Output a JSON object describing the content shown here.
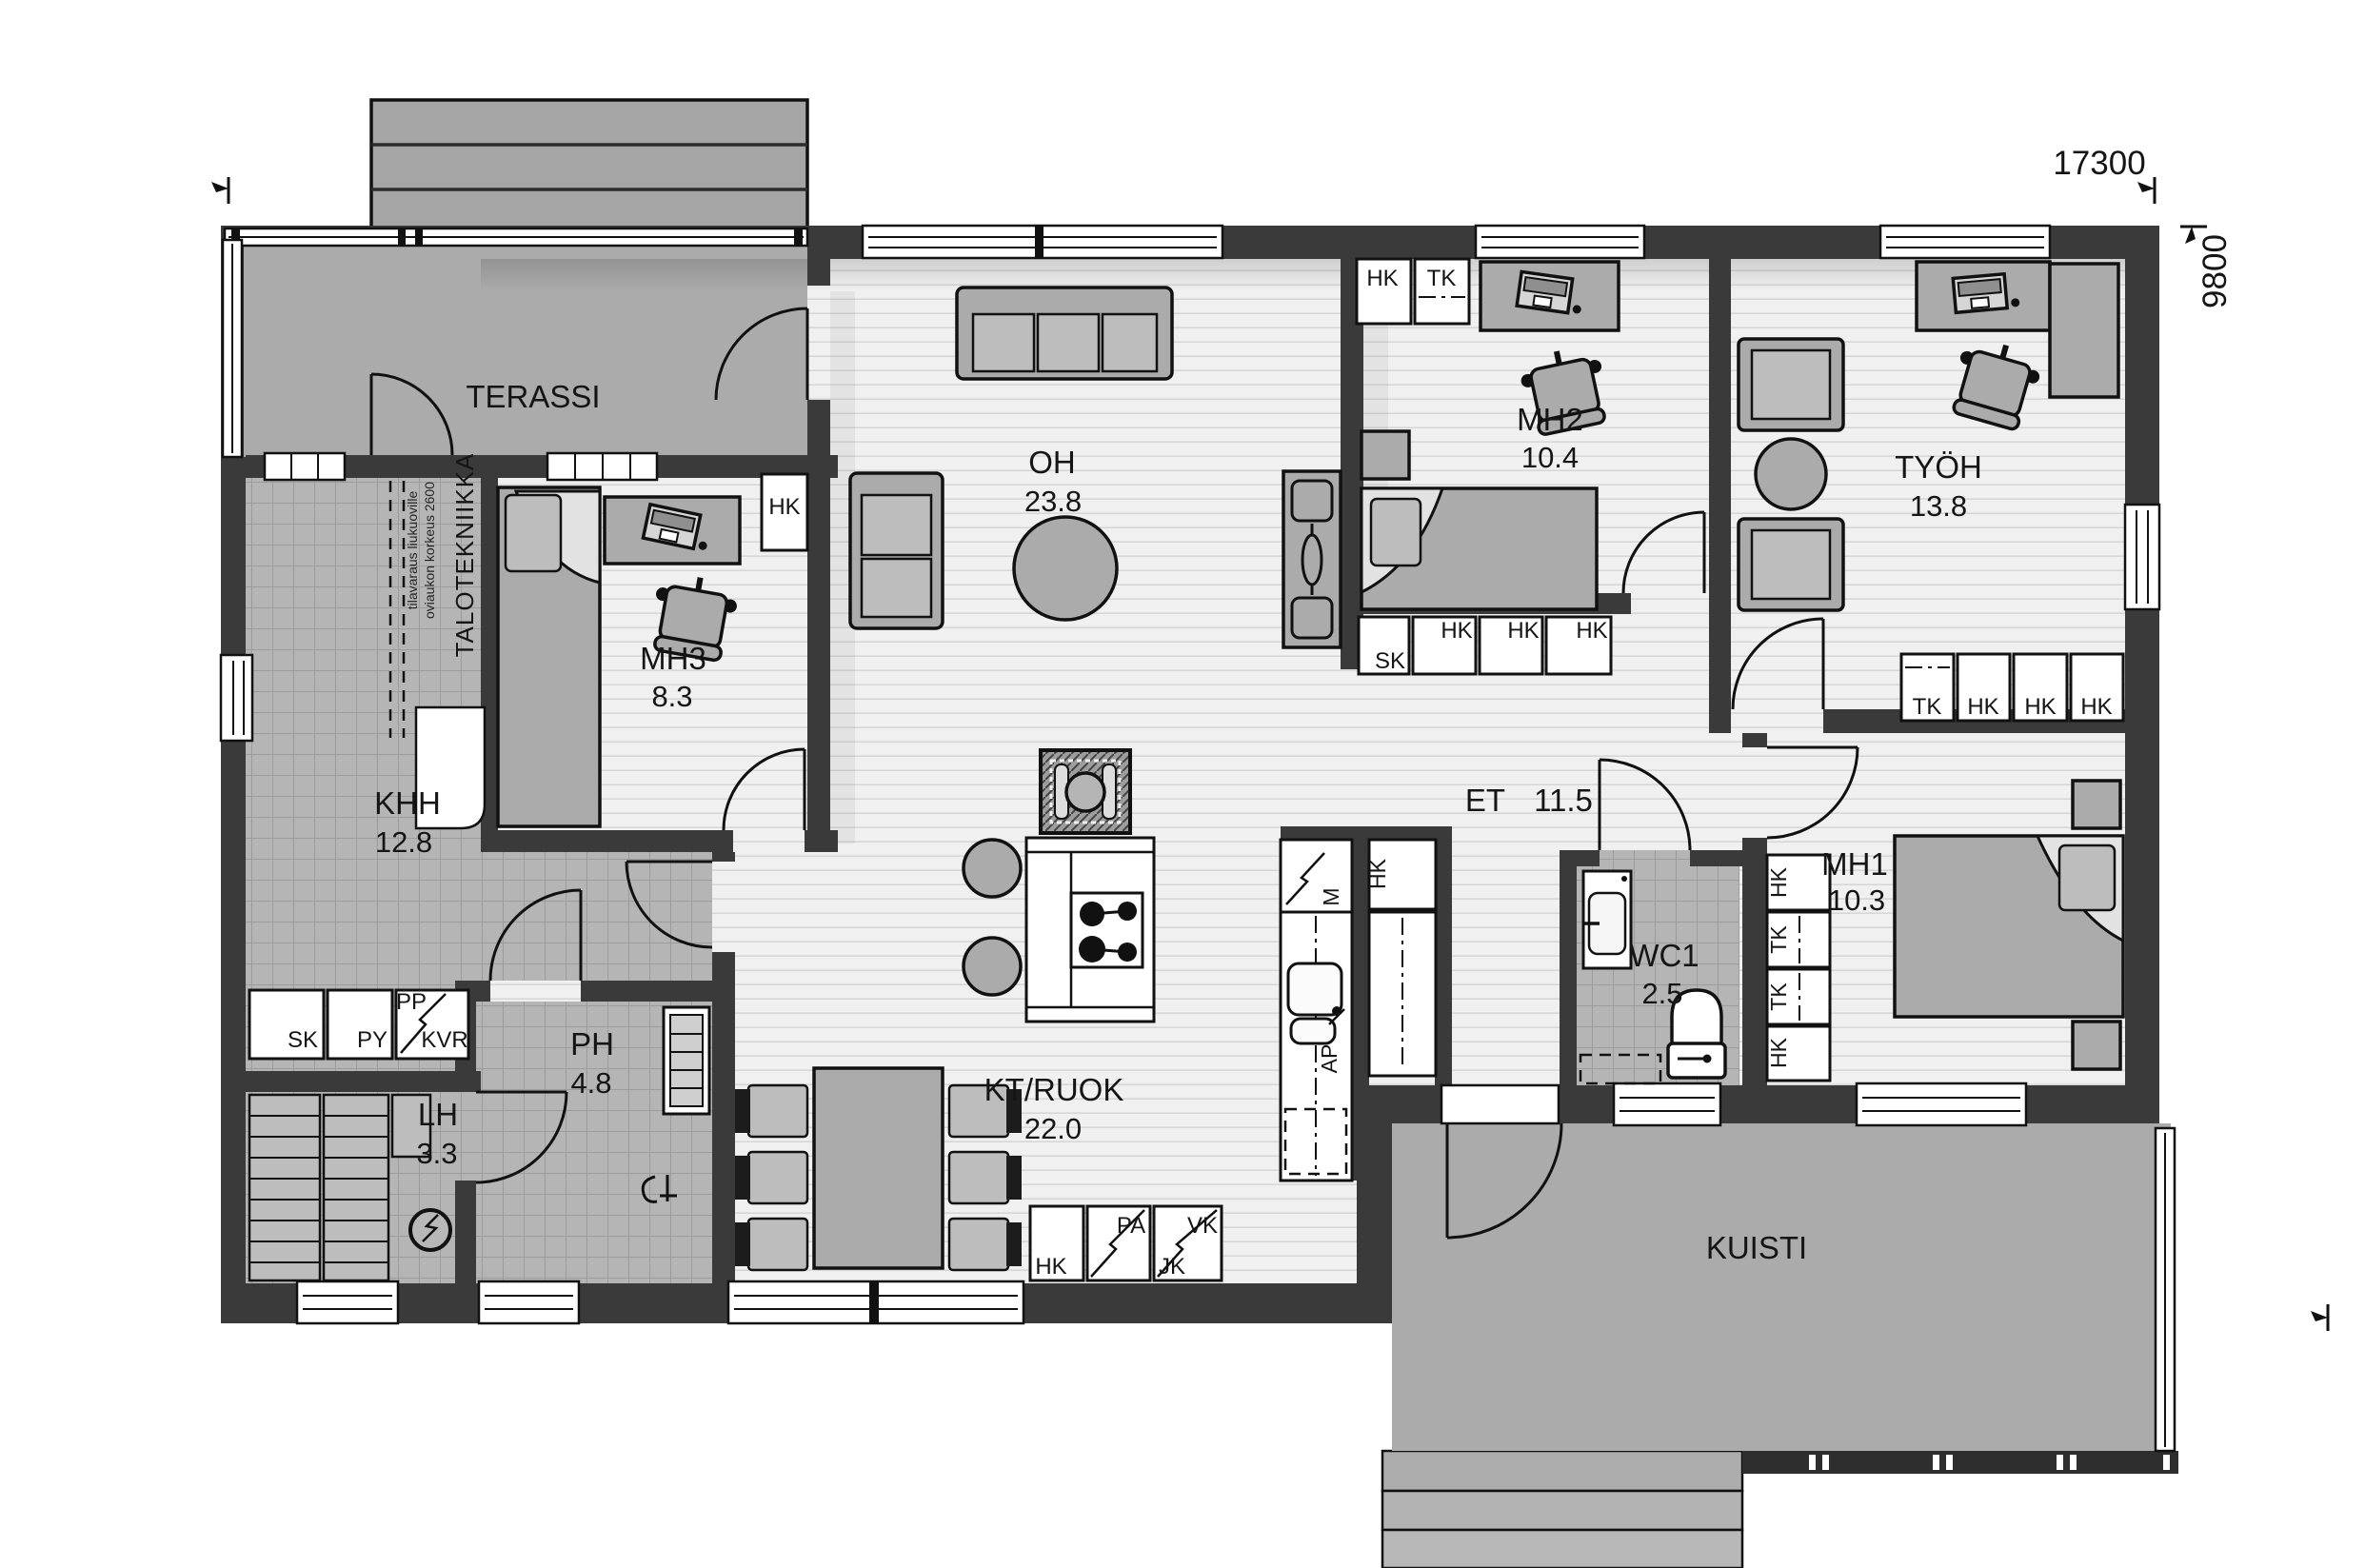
{
  "plan": {
    "dims": {
      "width_label": "17300",
      "height_label": "9800"
    },
    "rooms": {
      "terassi": {
        "name": "TERASSI"
      },
      "oh": {
        "name": "OH",
        "area": "23.8"
      },
      "mh2": {
        "name": "MH2",
        "area": "10.4"
      },
      "tyoh": {
        "name": "TYÖH",
        "area": "13.8"
      },
      "mh3": {
        "name": "MH3",
        "area": "8.3"
      },
      "khh": {
        "name": "KHH",
        "area": "12.8"
      },
      "et": {
        "name": "ET",
        "area": "11.5"
      },
      "mh1": {
        "name": "MH1",
        "area": "10.3"
      },
      "wc1": {
        "name": "WC1",
        "area": "2.5"
      },
      "ph": {
        "name": "PH",
        "area": "4.8"
      },
      "lh": {
        "name": "LH",
        "area": "3.3"
      },
      "ktruok": {
        "name": "KT/RUOK",
        "area": "22.0"
      },
      "kuisti": {
        "name": "KUISTI"
      }
    },
    "zones": {
      "talotekniikka": "TALOTEKNIIKKA"
    },
    "notes": {
      "line1": "tilavaraus liukuoville",
      "line2": "oviaukon korkeus 2600"
    },
    "cabinets": {
      "hk": "HK",
      "tk": "TK",
      "sk": "SK",
      "py": "PY",
      "pp": "PP",
      "kvr": "KVR",
      "pa": "PA",
      "vk": "VK",
      "jk": "JK",
      "m": "M",
      "ap": "AP"
    },
    "colors": {
      "wall": "#3a3a3a",
      "deck": "#ababab",
      "tile": "#b5b5b5",
      "wood_floor": "#f0f0f0",
      "furniture": "#ababab",
      "canopy": "#a5a5a5"
    }
  }
}
